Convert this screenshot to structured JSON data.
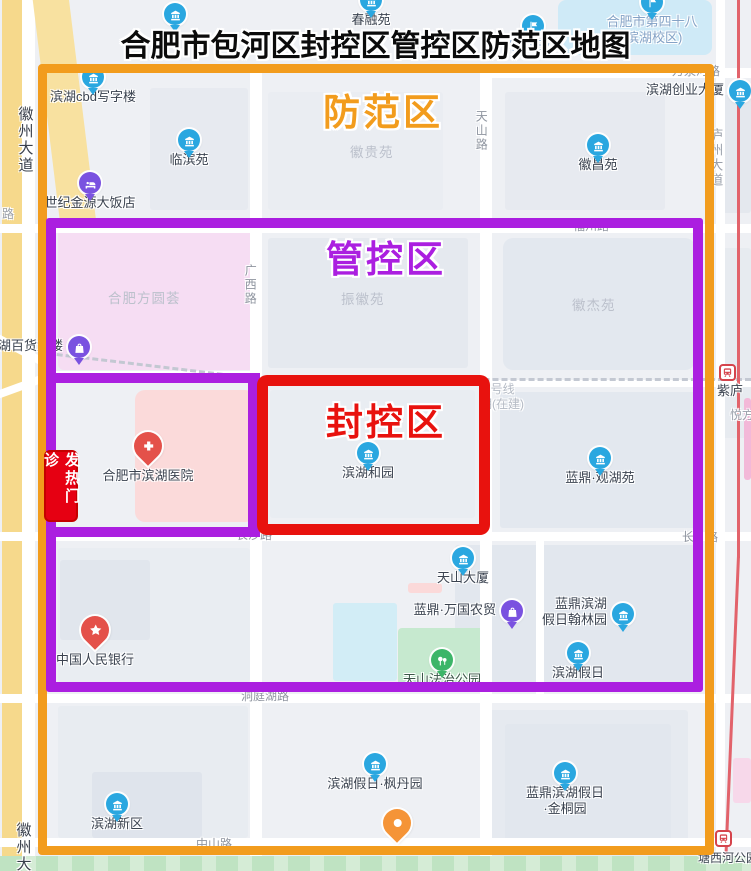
{
  "title": "合肥市包河区封控区管控区防范区地图",
  "zones": {
    "precaution": {
      "label": "防范区",
      "color": "#F29C1D"
    },
    "control": {
      "label": "管控区",
      "color": "#AB1FE0"
    },
    "sealed": {
      "label": "封控区",
      "color": "#E8120E"
    }
  },
  "fever_clinic_badge": {
    "text": "发热门诊",
    "bg": "#E60012",
    "border": "#C50000"
  },
  "map": {
    "pin_colors": {
      "blue": "#2AA7E0",
      "purple": "#7A52E0",
      "red": "#E4514A",
      "green": "#3CB568",
      "orange": "#F59437"
    },
    "metro_line_color": "#E2636B",
    "places": [
      {
        "id": "chunrongyuan",
        "label": "春融苑",
        "pin": "building",
        "color": "blue",
        "x": 371,
        "y": 0
      },
      {
        "id": "unlabeled-pin-north",
        "label": "",
        "pin": "building",
        "color": "blue",
        "x": 175,
        "y": 14
      },
      {
        "id": "hefei-no48-school",
        "lines": [
          "合肥市第四十八",
          "(滨湖校区)"
        ],
        "pin": "flag",
        "color": "blue",
        "x": 652,
        "y": 2,
        "label_color": "#84A2C6"
      },
      {
        "id": "fuxiao-sanxiao",
        "label": "附小三小",
        "pin": "flag",
        "color": "blue",
        "x": 533,
        "y": 26,
        "label_color": "#84A2C6"
      },
      {
        "id": "binhu-cbd-office",
        "label": "滨湖cbd写字楼",
        "pin": "building",
        "color": "blue",
        "x": 93,
        "y": 77
      },
      {
        "id": "binhu-chuangye-daxia",
        "label": "滨湖创业大厦",
        "pin": "building",
        "color": "blue",
        "x": 740,
        "y": 91,
        "label_pos": "left"
      },
      {
        "id": "linbinyuan",
        "label": "临滨苑",
        "pin": "building",
        "color": "blue",
        "x": 189,
        "y": 140
      },
      {
        "id": "huichangyuan",
        "label": "徽昌苑",
        "pin": "building",
        "color": "blue",
        "x": 598,
        "y": 145
      },
      {
        "id": "shiji-jinyuan-hotel",
        "label": "世纪金源大饭店",
        "pin": "bed",
        "color": "purple",
        "x": 90,
        "y": 183
      },
      {
        "id": "binhu-baihuo-dalou",
        "label": "滨湖百货大楼",
        "pin": "bag",
        "color": "purple",
        "x": 79,
        "y": 347,
        "label_pos": "left"
      },
      {
        "id": "binhu-heyuan",
        "label": "滨湖和园",
        "pin": "building",
        "color": "blue",
        "x": 368,
        "y": 453
      },
      {
        "id": "landing-guanhuyuan",
        "label": "蓝鼎·观湖苑",
        "pin": "building",
        "color": "blue",
        "x": 600,
        "y": 458
      },
      {
        "id": "binhu-hospital",
        "label": "合肥市滨湖医院",
        "pin": "cross",
        "color": "red",
        "x": 148,
        "y": 452,
        "big": true
      },
      {
        "id": "pboc-bank",
        "label": "中国人民银行",
        "pin": "star",
        "color": "red",
        "x": 95,
        "y": 636,
        "big": true
      },
      {
        "id": "tianshan-daxia",
        "label": "天山大厦",
        "pin": "building",
        "color": "blue",
        "x": 463,
        "y": 558
      },
      {
        "id": "landing-wanguo-nongmao",
        "label": "蓝鼎·万国农贸",
        "pin": "bag",
        "color": "purple",
        "x": 512,
        "y": 611,
        "label_pos": "left"
      },
      {
        "id": "landing-binhu-holiday-hanlin",
        "lines": [
          "蓝鼎滨湖",
          "假日翰林园"
        ],
        "pin": "building",
        "color": "blue",
        "x": 623,
        "y": 614,
        "label_pos": "left"
      },
      {
        "id": "binhu-holiday",
        "label": "滨湖假日",
        "pin": "building",
        "color": "blue",
        "x": 578,
        "y": 653
      },
      {
        "id": "tianshan-fazhi-park",
        "label": "天山法治公园",
        "pin": "park",
        "color": "green",
        "x": 442,
        "y": 660,
        "label_color": "#3B5548"
      },
      {
        "id": "binhu-holiday-fengdanyuan",
        "label": "滨湖假日·枫丹园",
        "pin": "building",
        "color": "blue",
        "x": 375,
        "y": 764
      },
      {
        "id": "landing-binhu-holiday-jintongyuan",
        "lines": [
          "蓝鼎滨湖假日",
          "·金桐园"
        ],
        "pin": "building",
        "color": "blue",
        "x": 565,
        "y": 773
      },
      {
        "id": "binhu-xinqu",
        "label": "滨湖新区",
        "pin": "building",
        "color": "blue",
        "x": 117,
        "y": 804
      },
      {
        "id": "unlabeled-pin-south",
        "label": "",
        "pin": "flame",
        "color": "orange",
        "x": 397,
        "y": 829,
        "big": true
      }
    ],
    "stations": [
      {
        "name": "紫庐",
        "x": 727,
        "y": 372
      },
      {
        "name": "塘西河公园",
        "x": 723,
        "y": 838
      }
    ],
    "road_labels": [
      {
        "text": "徽州大道",
        "x": 16,
        "y": 106,
        "vertical": true,
        "color": "#3A404C",
        "size": 15
      },
      {
        "text": "徽州大",
        "x": 14,
        "y": 822,
        "vertical": true,
        "color": "#3A404C",
        "size": 15
      },
      {
        "text": "路",
        "x": 2,
        "y": 208,
        "color": "#9AA0AB",
        "size": 12
      },
      {
        "text": "庐州大道",
        "x": 708,
        "y": 128,
        "vertical": true,
        "color": "#9AA0AB",
        "size": 13
      },
      {
        "text": "万泉河路",
        "x": 672,
        "y": 65,
        "color": "#8F95A0",
        "size": 12
      },
      {
        "text": "广西路",
        "x": 243,
        "y": 264,
        "vertical": true,
        "color": "#8F95A0",
        "size": 12
      },
      {
        "text": "天山路",
        "x": 474,
        "y": 110,
        "vertical": true,
        "color": "#8F95A0",
        "size": 12
      },
      {
        "text": "福州路",
        "x": 573,
        "y": 220,
        "color": "#8F95A0",
        "size": 12
      },
      {
        "text": "长沙路",
        "x": 236,
        "y": 529,
        "color": "#8F95A0",
        "size": 12
      },
      {
        "text": "长",
        "x": 682,
        "y": 531,
        "color": "#8F95A0",
        "size": 12
      },
      {
        "text": "路",
        "x": 706,
        "y": 531,
        "color": "#8F95A0",
        "size": 12
      },
      {
        "text": "洞庭湖路",
        "x": 241,
        "y": 690,
        "color": "#8F95A0",
        "size": 12
      },
      {
        "text": "中山路",
        "x": 196,
        "y": 838,
        "color": "#8F95A0",
        "size": 12
      },
      {
        "text": "7号线",
        "x": 484,
        "y": 383,
        "color": "#B4BAC4",
        "size": 12
      },
      {
        "text": "期(在建)",
        "x": 480,
        "y": 398,
        "color": "#B4BAC4",
        "size": 12
      },
      {
        "text": "悦方",
        "x": 730,
        "y": 409,
        "color": "#9AA0AB",
        "size": 12
      },
      {
        "text": "塘西河公园",
        "x": 698,
        "y": 852,
        "color": "#3B4350",
        "size": 12
      }
    ],
    "area_labels": [
      {
        "text": "徽贵苑",
        "x": 350,
        "y": 141
      },
      {
        "text": "振徽苑",
        "x": 341,
        "y": 288
      },
      {
        "text": "徽杰苑",
        "x": 572,
        "y": 294
      },
      {
        "text": "合肥方圆荟",
        "x": 108,
        "y": 287
      }
    ]
  }
}
